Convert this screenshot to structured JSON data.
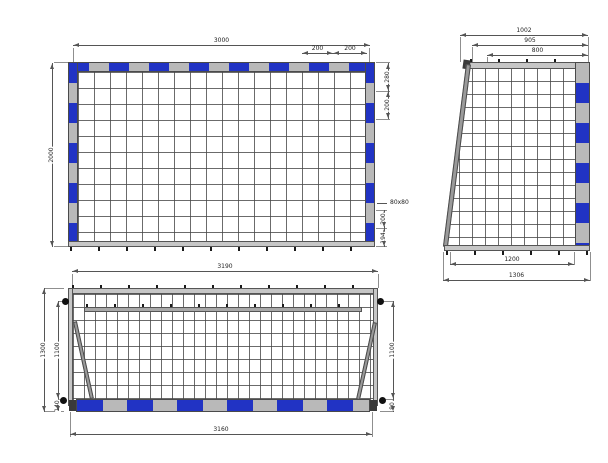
{
  "drawing_title": "Goal technical drawing (front, side and plan views)",
  "colors": {
    "band_blue": "#2133c4",
    "band_gray": "#b9b9b9",
    "dim_line": "#555555"
  },
  "views": {
    "front": {
      "dims": {
        "width": "3000",
        "height": "2000",
        "top_band_a": "200",
        "top_band_b": "200",
        "corner_band": "280",
        "side_band": "200",
        "profile": "80x80",
        "post_band": "200",
        "post_foot": "194"
      }
    },
    "side": {
      "dims": {
        "depth_top": "1002",
        "depth_mid": "905",
        "depth_inner": "800",
        "base_inner": "1200",
        "base_outer": "1306"
      }
    },
    "plan": {
      "dims": {
        "width_top": "3190",
        "width_bottom": "3160",
        "depth_outer": "1300",
        "depth_inner_left": "1100",
        "offset_left": "140",
        "depth_inner_right": "1100",
        "offset_right": "80"
      }
    }
  }
}
